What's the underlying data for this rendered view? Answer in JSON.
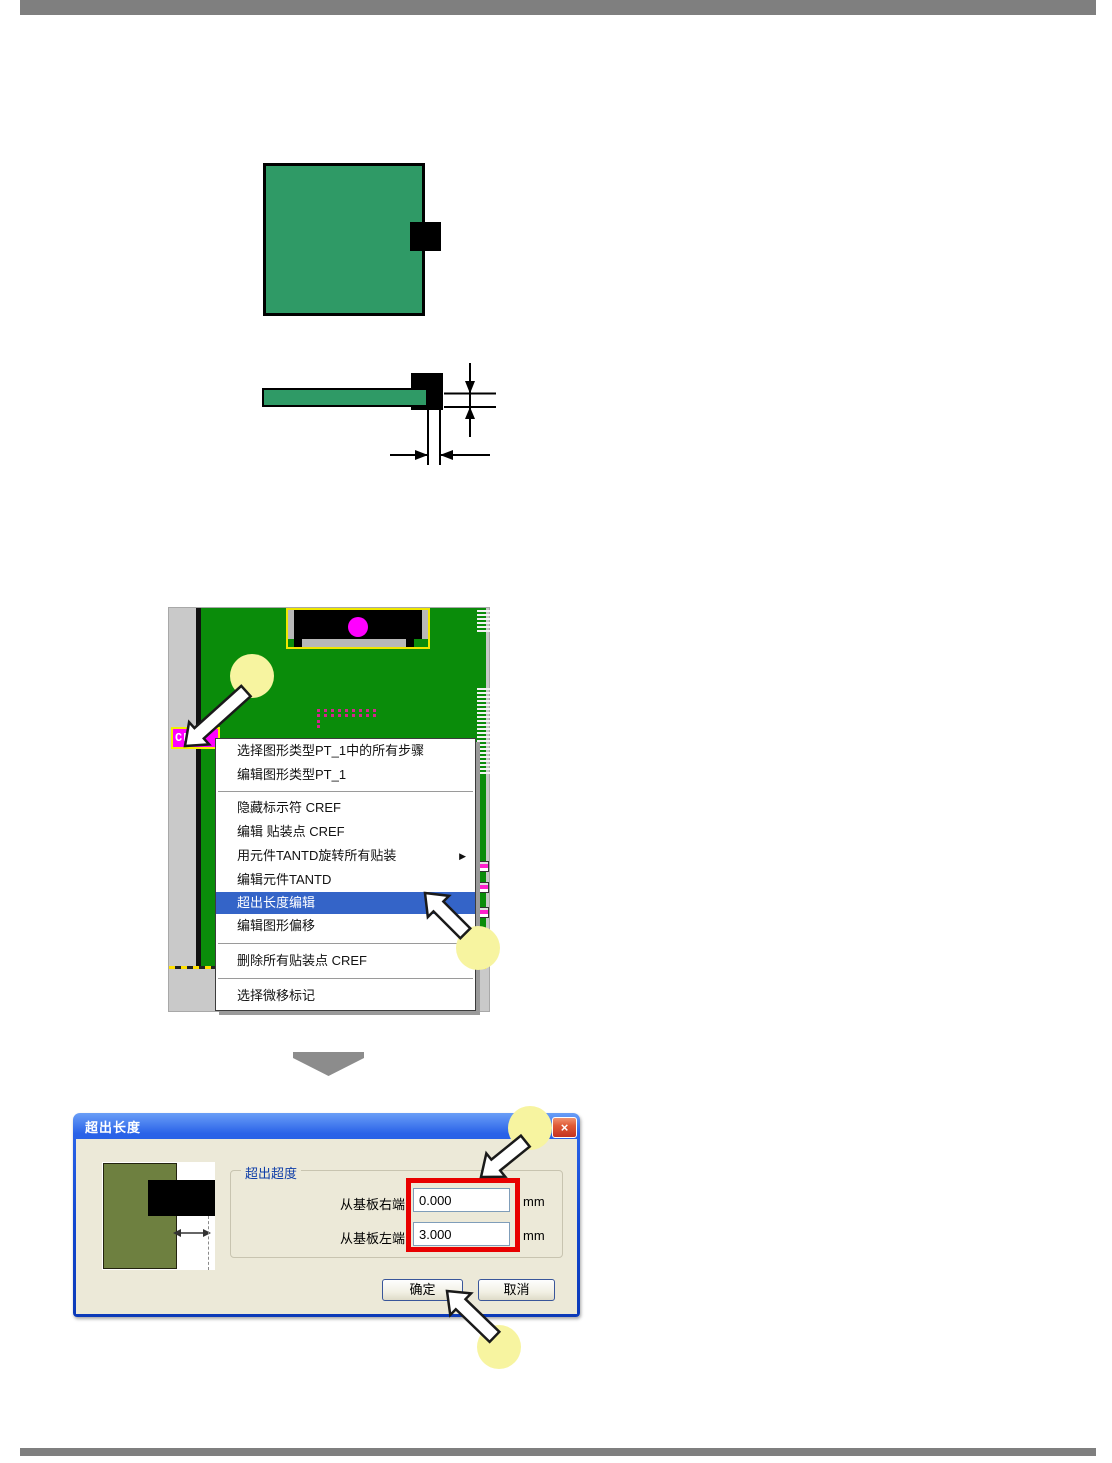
{
  "pcb_screenshot": {
    "cref_label": "CREF"
  },
  "context_menu": {
    "submenu_arrow": "▶",
    "items": [
      {
        "label": "选择图形类型PT_1中的所有步骤"
      },
      {
        "label": "编辑图形类型PT_1"
      },
      {
        "label": "隐藏标示符 CREF"
      },
      {
        "label": "编辑 贴装点 CREF"
      },
      {
        "label": "用元件TANTD旋转所有贴装",
        "has_submenu": true
      },
      {
        "label": "编辑元件TANTD"
      },
      {
        "label": "超出长度编辑",
        "highlighted": true
      },
      {
        "label": "编辑图形偏移"
      },
      {
        "label": "删除所有贴装点 CREF"
      },
      {
        "label": "选择微移标记"
      }
    ]
  },
  "dialog": {
    "title": "超出长度",
    "close_glyph": "×",
    "group_label": "超出超度",
    "fields": [
      {
        "label": "从基板右端",
        "value": "0.000",
        "unit": "mm"
      },
      {
        "label": "从基板左端",
        "value": "3.000",
        "unit": "mm"
      }
    ],
    "ok_label": "确定",
    "cancel_label": "取消"
  },
  "colors": {
    "pcb_green": "#0a8c0a",
    "figure_green": "#2f9a66",
    "magenta": "#ff00ff",
    "menu_highlight": "#3464c8",
    "annotation_red": "#e80000",
    "callout_yellow": "#f7f4a0",
    "title_bar_blue": "#1046cf",
    "olive_preview": "#6e8040"
  }
}
